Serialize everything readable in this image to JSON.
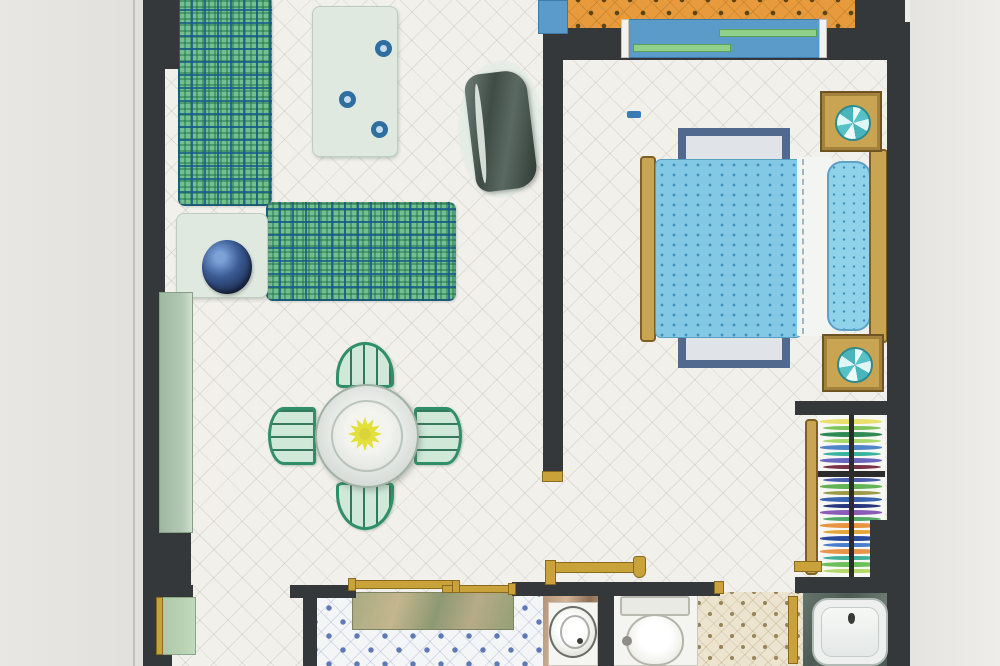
{
  "scene": {
    "type": "apartment floor plan photograph, top-down view, no text labels",
    "rooms": [
      "living-dining-room",
      "bedroom",
      "balcony",
      "hallway",
      "closet",
      "kitchen",
      "bathroom"
    ],
    "furniture": [
      "l-shaped-plaid-sofa",
      "coffee-table-with-cups",
      "tv",
      "side-table-with-plant",
      "round-dining-table",
      "four-dining-chairs",
      "double-bed",
      "two-nightstands-with-lamps",
      "bed-rug",
      "wardrobe-clothes",
      "kitchen-counter",
      "sliding-door-tracks",
      "washbasin",
      "toilet",
      "bathtub",
      "balcony-window",
      "left-wall-window",
      "left-wall-door"
    ]
  },
  "colors": {
    "wall": "#35383a",
    "paper": "#e4e2de",
    "balcony": "#e79b3c",
    "plaidbase": "#74bf92",
    "cupring": "#2f6fa0",
    "paletable": "#dfe9df",
    "tan": "#c9a452",
    "rugblue": "#50698c",
    "rugfill": "#e0e4e8",
    "bedblue": "#83c9e6",
    "beddot": "#3f8fb8",
    "pillow": "#90d2ea",
    "gold": "#c9a23a",
    "winblue": "#5b9bc9",
    "wingreen": "#8fd08a",
    "bathfloor": "#ede4d0",
    "chairgreen": "#2f8f68",
    "flower": "#e3df3c"
  },
  "closet": {
    "clothes_colors": [
      "#e8e06a",
      "#7cc45a",
      "#2f8a56",
      "#a8d86a",
      "#4f86c9",
      "#39b3a0",
      "#6a66c0",
      "#7a3148",
      "#c25a90",
      "#4a5fae",
      "#62b356",
      "#9a9a48",
      "#3a63b0",
      "#27357c",
      "#8a5cb8",
      "#52a868",
      "#e8953f",
      "#e2a63a",
      "#2a4a9c",
      "#4a7ecc",
      "#e8944a",
      "#3fb09a",
      "#6cc05c",
      "#b2d86a"
    ]
  },
  "coffee_table": {
    "cup_count": 3
  }
}
